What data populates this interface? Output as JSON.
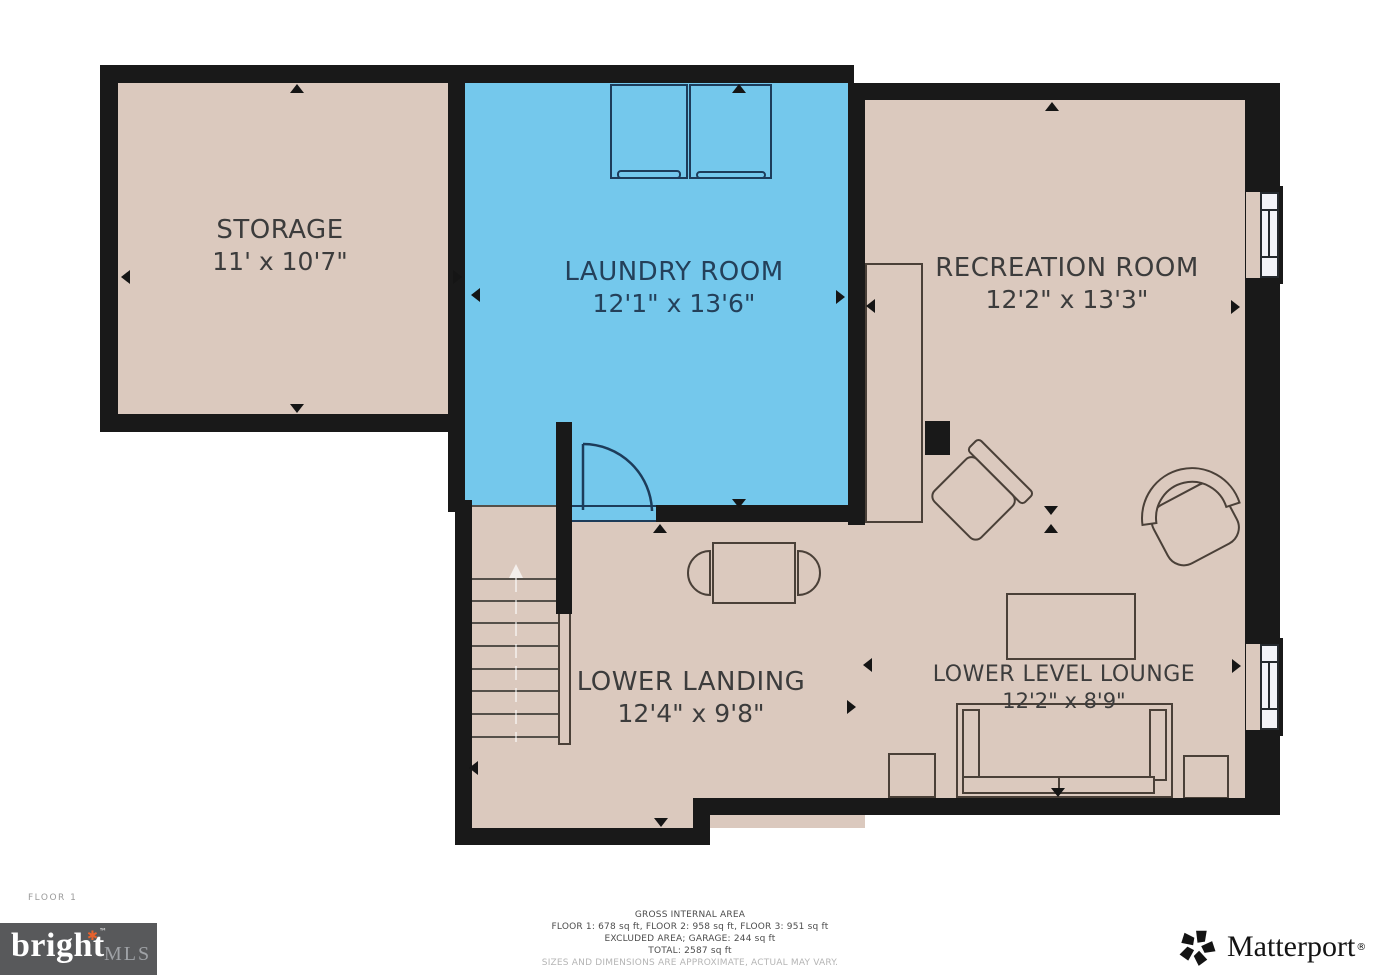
{
  "floor_label": "FLOOR 1",
  "rooms": {
    "storage": {
      "name": "STORAGE",
      "dims": "11' x 10'7\""
    },
    "laundry": {
      "name": "LAUNDRY ROOM",
      "dims": "12'1\" x 13'6\""
    },
    "recreation": {
      "name": "RECREATION ROOM",
      "dims": "12'2\" x 13'3\""
    },
    "landing": {
      "name": "LOWER LANDING",
      "dims": "12'4\" x 9'8\""
    },
    "lounge": {
      "name": "LOWER LEVEL LOUNGE",
      "dims": "12'2\" x 8'9\""
    }
  },
  "footer": {
    "line1": "GROSS INTERNAL AREA",
    "line2": "FLOOR 1: 678 sq ft, FLOOR 2: 958 sq ft, FLOOR 3: 951 sq ft",
    "line3": "EXCLUDED AREA; GARAGE: 244 sq ft",
    "line4": "TOTAL: 2587 sq ft",
    "line5": "SIZES AND DIMENSIONS ARE APPROXIMATE, ACTUAL MAY VARY."
  },
  "logos": {
    "bright_mls": {
      "word": "bright",
      "mark": "✱",
      "tm": "™",
      "mls": "MLS"
    },
    "matterport": {
      "text": "Matterport",
      "reg": "®"
    }
  },
  "colors": {
    "floor_beige": "#dbc9be",
    "floor_blue": "#74c8ec",
    "wall": "#191919",
    "label_dark": "#3c3c3c",
    "label_navy": "#24405a",
    "bright_orange": "#e8622d",
    "bright_box_gray": "#58595b"
  }
}
